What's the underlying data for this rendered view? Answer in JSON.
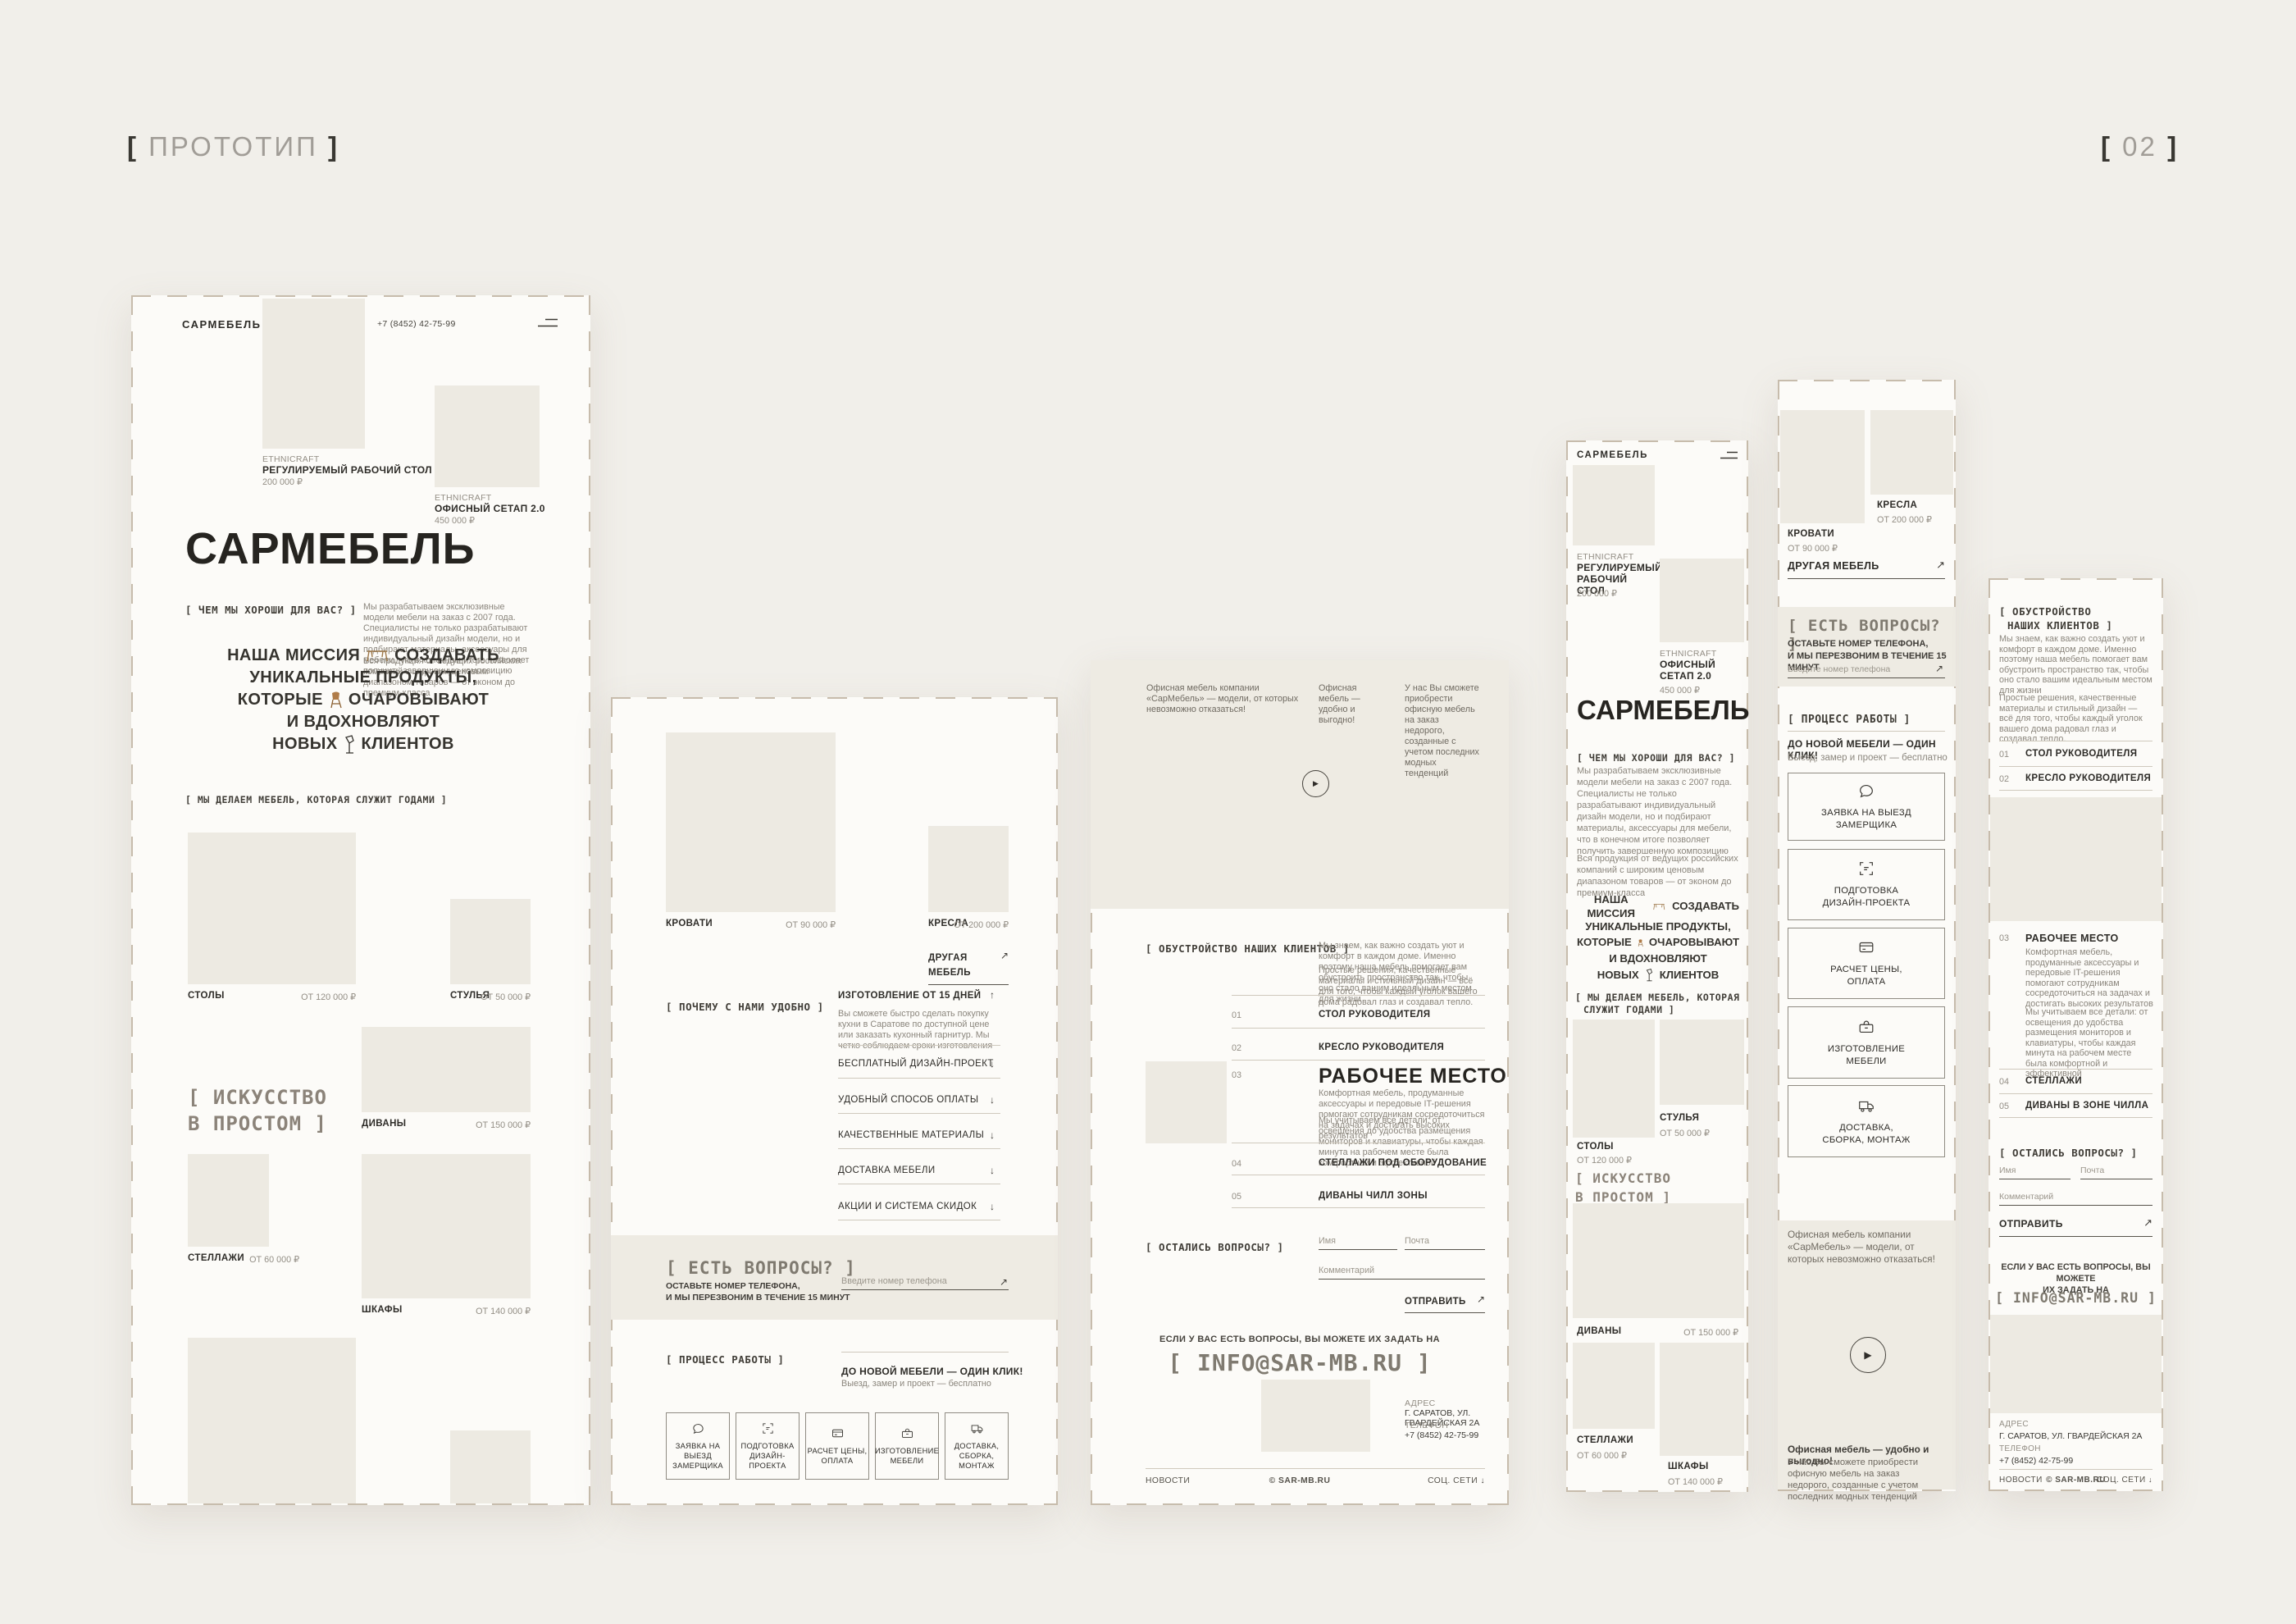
{
  "page": {
    "proto_bracket_open": "[",
    "proto_label": "ПРОТОТИП",
    "proto_bracket_close": "]",
    "num_bracket_open": "[",
    "num_label": "02",
    "num_bracket_close": "]"
  },
  "icons": {
    "arrow_ne": "↗",
    "arrow_up": "↑",
    "arrow_down": "↓",
    "play": "▶"
  },
  "brand": {
    "logo": "САРМЕБЕЛЬ",
    "phone": "+7 (8452) 42-75-99"
  },
  "hero": {
    "title": "САРМЕБЕЛЬ"
  },
  "products": [
    {
      "brand": "ETHNICRAFT",
      "name": "РЕГУЛИРУЕМЫЙ РАБОЧИЙ СТОЛ",
      "price": "200 000 ₽"
    },
    {
      "brand": "ETHNICRAFT",
      "name": "ОФИСНЫЙ СЕТАП 2.0",
      "price": "450 000 ₽"
    }
  ],
  "about": {
    "label": "[ ЧЕМ МЫ ХОРОШИ ДЛЯ ВАС? ]",
    "p1": "Мы разрабатываем эксклюзивные модели мебели на заказ с 2007 года. Специалисты не только разрабатывают индивидуальный дизайн модели, но и подбирают материалы, аксессуары для мебели, что в конечном итоге позволяет получить завершенную композицию",
    "p2": "Вся продукция от ведущих российских компаний с широким ценовым диапазоном товаров — от эконом до премиум-класса"
  },
  "mission": {
    "l1a": "НАША МИССИЯ",
    "l1b": "СОЗДАВАТЬ",
    "l2": "УНИКАЛЬНЫЕ ПРОДУКТЫ,",
    "l3a": "КОТОРЫЕ",
    "l3b": "ОЧАРОВЫВАЮТ",
    "l4": "И ВДОХНОВЛЯЮТ",
    "l5a": "НОВЫХ",
    "l5b": "КЛИЕНТОВ"
  },
  "catalog": {
    "label": "[ МЫ ДЕЛАЕМ МЕБЕЛЬ, КОТОРАЯ СЛУЖИТ ГОДАМИ ]",
    "label_m1": "[ МЫ ДЕЛАЕМ МЕБЕЛЬ, КОТОРАЯ",
    "label_m2": "СЛУЖИТ ГОДАМИ ]",
    "art1": "[ ИСКУССТВО",
    "art2": "В ПРОСТОМ ]",
    "other_link": "ДРУГАЯ МЕБЕЛЬ",
    "items": [
      {
        "name": "СТОЛЫ",
        "price": "ОТ 120 000 ₽"
      },
      {
        "name": "СТУЛЬЯ",
        "price": "ОТ 50 000 ₽"
      },
      {
        "name": "ДИВАНЫ",
        "price": "ОТ 150 000 ₽"
      },
      {
        "name": "СТЕЛЛАЖИ",
        "price": "ОТ 60 000 ₽"
      },
      {
        "name": "ШКАФЫ",
        "price": "ОТ 140 000 ₽"
      },
      {
        "name": "КРОВАТИ",
        "price": "ОТ 90 000 ₽"
      },
      {
        "name": "КРЕСЛА",
        "price": "ОТ 200 000 ₽"
      }
    ]
  },
  "why": {
    "label": "[ ПОЧЕМУ С НАМИ УДОБНО ]",
    "items": [
      {
        "title": "ИЗГОТОВЛЕНИЕ ОТ 15 ДНЕЙ",
        "body": "Вы сможете быстро сделать покупку кухни в Саратове по доступной цене или заказать кухонный гарнитур. Мы четко соблюдаем сроки изготовления"
      },
      {
        "title": "БЕСПЛАТНЫЙ ДИЗАЙН-ПРОЕКТ"
      },
      {
        "title": "УДОБНЫЙ СПОСОБ ОПЛАТЫ"
      },
      {
        "title": "КАЧЕСТВЕННЫЕ МАТЕРИАЛЫ"
      },
      {
        "title": "ДОСТАВКА МЕБЕЛИ"
      },
      {
        "title": "АКЦИИ И СИСТЕМА СКИДОК"
      }
    ]
  },
  "cta": {
    "label": "[ ЕСТЬ ВОПРОСЫ? ]",
    "sub1": "ОСТАВЬТЕ НОМЕР ТЕЛЕФОНА,",
    "sub2": "И МЫ ПЕРЕЗВОНИМ В ТЕЧЕНИЕ 15 МИНУТ",
    "placeholder": "Введите номер телефона"
  },
  "process": {
    "label": "[ ПРОЦЕСС РАБОТЫ ]",
    "title": "ДО НОВОЙ МЕБЕЛИ — ОДИН КЛИК!",
    "sub": "Выезд, замер и проект — бесплатно",
    "steps": [
      {
        "l1": "ЗАЯВКА НА ВЫЕЗД",
        "l2": "ЗАМЕРЩИКА"
      },
      {
        "l1": "ПОДГОТОВКА",
        "l2": "ДИЗАЙН-ПРОЕКТА"
      },
      {
        "l1": "РАСЧЕТ ЦЕНЫ,",
        "l2": "ОПЛАТА"
      },
      {
        "l1": "ИЗГОТОВЛЕНИЕ",
        "l2": "МЕБЕЛИ"
      },
      {
        "l1": "ДОСТАВКА,",
        "l2": "СБОРКА, МОНТАЖ"
      }
    ]
  },
  "promo": {
    "t1": "Офисная мебель компании «СарМебель» — модели, от которых невозможно отказаться!",
    "t2": "Офисная мебель — удобно и выгодно!",
    "t3": "У нас Вы сможете приобрести офисную мебель на заказ недорого, созданные с учетом последних модных тенденций"
  },
  "clients": {
    "label": "[ ОБУСТРОЙСТВО НАШИХ КЛИЕНТОВ ]",
    "label_m1": "[ ОБУСТРОЙСТВО",
    "label_m2": "НАШИХ КЛИЕНТОВ ]",
    "p1": "Мы знаем, как важно создать уют и комфорт в каждом доме. Именно поэтому наша мебель помогает вам обустроить пространство так, чтобы оно стало вашим идеальным местом для жизни",
    "p2": "Простые решения, качественные материалы и стильный дизайн — всё для того, чтобы каждый уголок вашего дома радовал глаз и создавал тепло.",
    "items": [
      {
        "num": "01",
        "title": "СТОЛ РУКОВОДИТЕЛЯ"
      },
      {
        "num": "02",
        "title": "КРЕСЛО РУКОВОДИТЕЛЯ"
      },
      {
        "num": "03",
        "title": "РАБОЧЕЕ МЕСТО",
        "b1": "Комфортная мебель, продуманные аксессуары и передовые IT-решения помогают сотрудникам сосредоточиться на задачах и достигать высоких результатов",
        "b2": "Мы учитываем все детали: от освещения до удобства размещения мониторов и клавиатуры, чтобы каждая минута на рабочем месте была комфортной и эффективной"
      },
      {
        "num": "04",
        "title": "СТЕЛЛАЖИ ПОД ОБОРУДОВАНИЕ",
        "title_m": "СТЕЛЛАЖИ"
      },
      {
        "num": "05",
        "title": "ДИВАНЫ ЧИЛЛ ЗОНЫ",
        "title_m": "ДИВАНЫ В ЗОНЕ ЧИЛЛА"
      }
    ]
  },
  "form": {
    "label": "[ ОСТАЛИСЬ ВОПРОСЫ? ]",
    "name": "Имя",
    "mail": "Почта",
    "comment": "Комментарий",
    "submit": "ОТПРАВИТЬ"
  },
  "contact": {
    "question": "ЕСЛИ У ВАС ЕСТЬ ВОПРОСЫ, ВЫ МОЖЕТЕ ИХ ЗАДАТЬ НА",
    "question_m1": "ЕСЛИ У ВАС ЕСТЬ ВОПРОСЫ, ВЫ МОЖЕТЕ",
    "question_m2": "ИХ ЗАДАТЬ НА",
    "email": "[ INFO@SAR-MB.RU ]",
    "address_label": "АДРЕС",
    "address": "Г. САРАТОВ, УЛ. ГВАРДЕЙСКАЯ 2А",
    "phone_label": "ТЕЛЕФОН",
    "phone": "+7 (8452) 42-75-99"
  },
  "footer": {
    "news": "НОВОСТИ",
    "copyright": "© SAR-MB.RU",
    "social": "СОЦ. СЕТИ"
  }
}
